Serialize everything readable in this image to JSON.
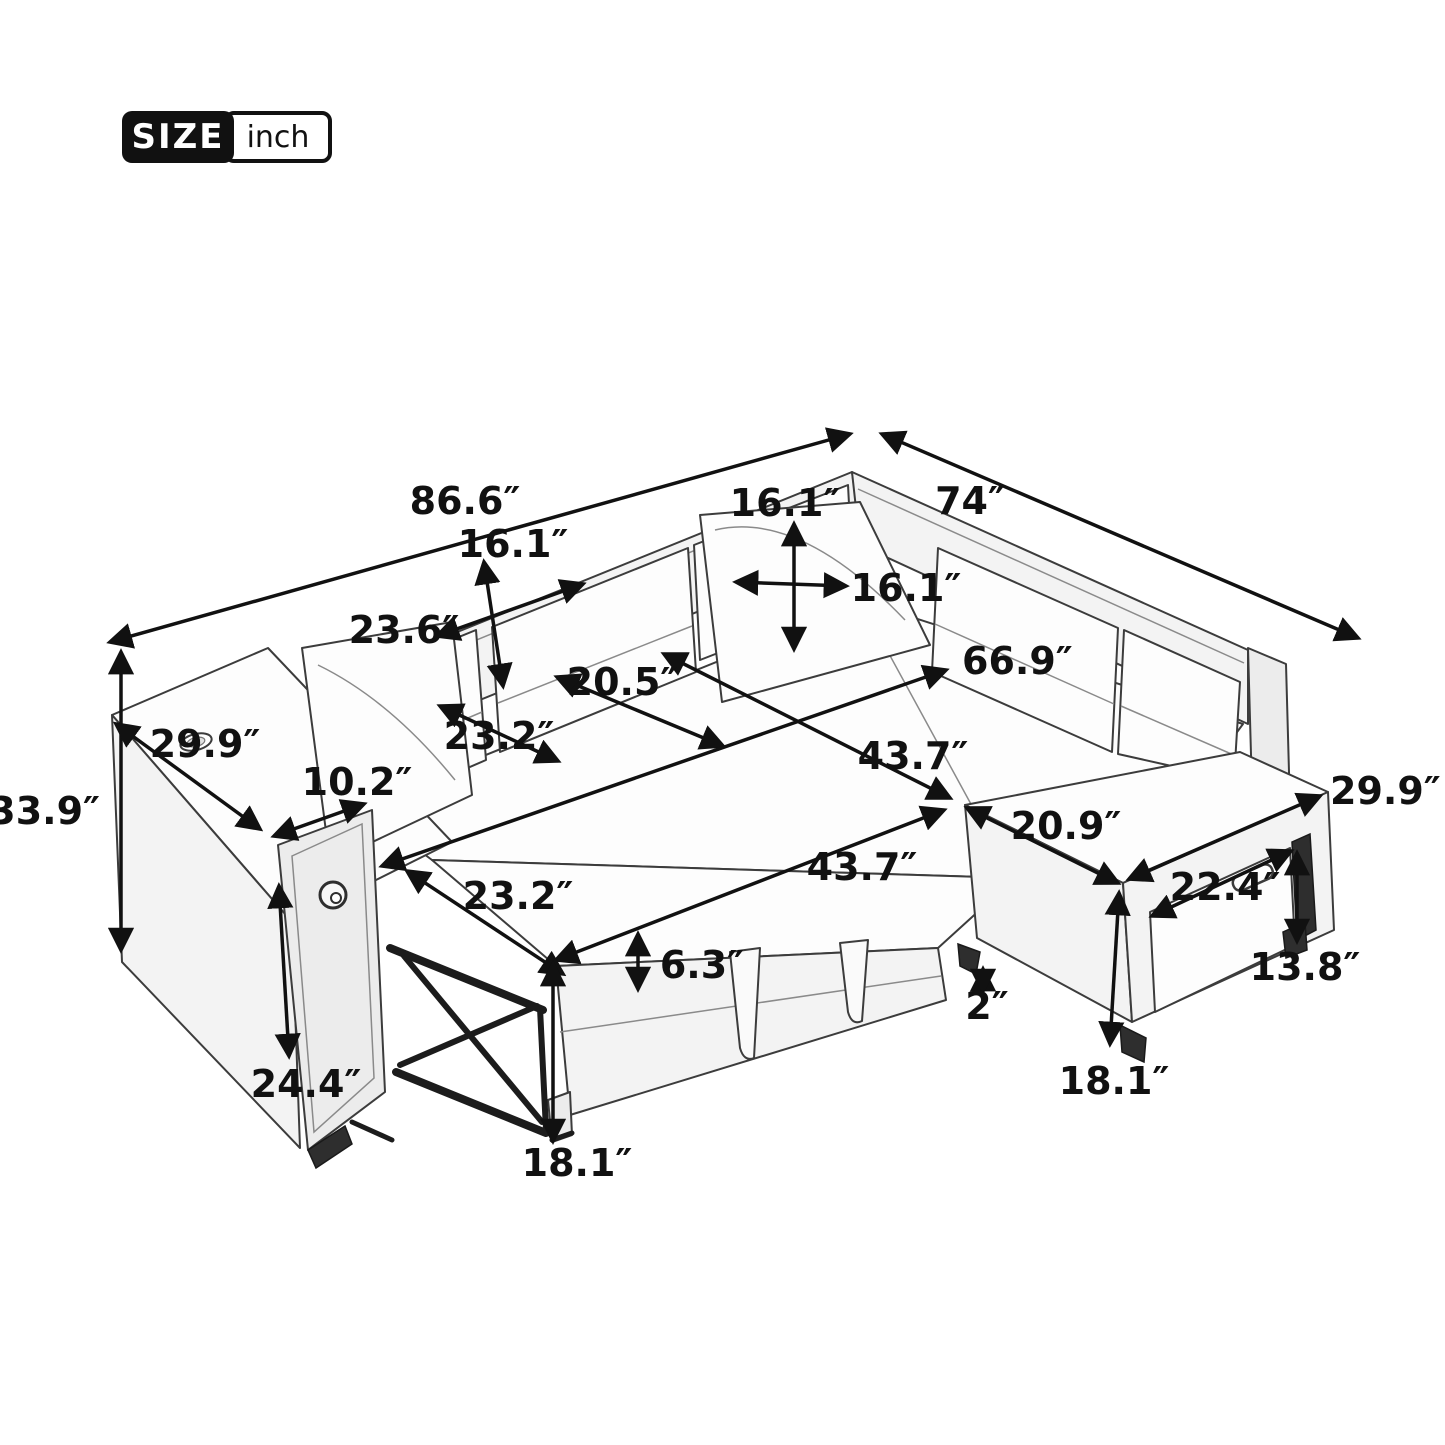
{
  "title_badge": {
    "size_label": "SIZE",
    "unit_label": "inch"
  },
  "diagram": {
    "subject": "sectional-sleeper-sofa-dimension-diagram",
    "unit": "inch",
    "dimensions": {
      "total_length": "86.6″",
      "total_depth": "74″",
      "back_cushion_height": "16.1″",
      "pillow_height": "16.1″",
      "pillow_width": "16.1″",
      "back_cushion_width": "23.6″",
      "seat_length_right": "66.9″",
      "seat_depth": "20.5″",
      "armrest_top_depth": "29.9″",
      "seat_cushion_width": "23.2″",
      "seat_length": "43.7″",
      "armrest_panel_width": "10.2″",
      "overall_height": "33.9″",
      "ottoman_width": "29.9″",
      "ottoman_depth": "20.9″",
      "bed_length": "43.7″",
      "drawer_width": "22.4″",
      "bed_width": "23.2″",
      "mattress_thickness": "6.3″",
      "drawer_height": "13.8″",
      "caster_clearance": "2″",
      "armrest_front_height": "24.4″",
      "ottoman_height": "18.1″",
      "bed_height": "18.1″"
    }
  }
}
